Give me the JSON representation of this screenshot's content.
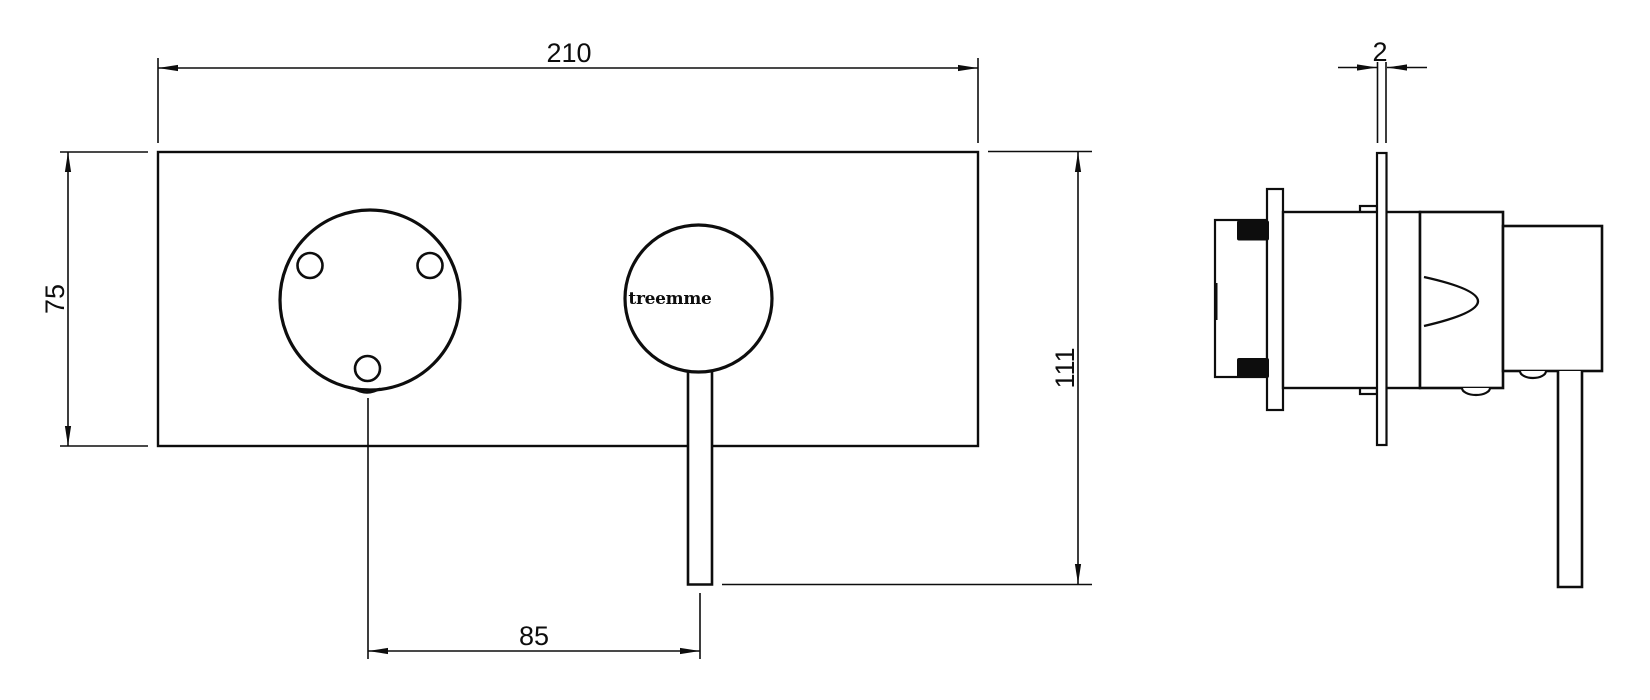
{
  "drawing": {
    "background": "#ffffff",
    "line_color": "#0d0d0d",
    "brand": {
      "logo_text": "treemme"
    },
    "views": {
      "front": {
        "dimensions": {
          "plate_width_mm": "210",
          "plate_height_mm": "75",
          "handle_axis_spacing_mm": "85",
          "overall_height_mm": "111"
        }
      },
      "side": {
        "dimensions": {
          "plate_thickness_mm": "2"
        }
      }
    }
  }
}
